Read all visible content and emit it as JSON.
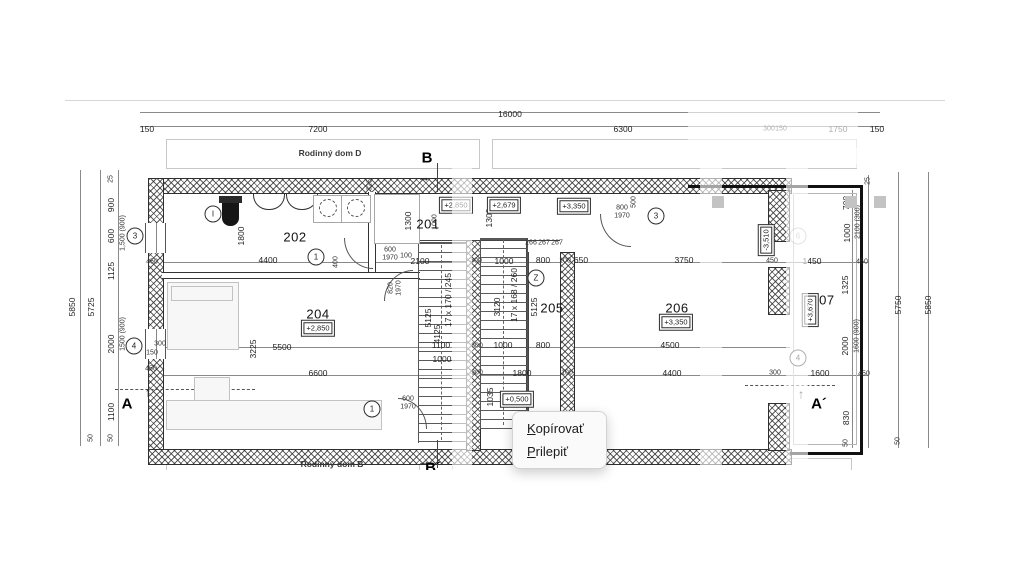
{
  "context_menu": {
    "items": [
      {
        "label": "Kopírovať",
        "mnemonic": "K",
        "rest": "opírovať"
      },
      {
        "label": "Prilepiť",
        "mnemonic": "P",
        "rest": "rilepiť"
      }
    ]
  },
  "plan": {
    "building_labels": [
      {
        "t": "Rodinný dom D",
        "x": 330,
        "y": 153
      },
      {
        "t": "Rodinný dom B",
        "x": 332,
        "y": 464
      }
    ],
    "section_markers": [
      {
        "t": "B",
        "x": 427,
        "y": 158
      },
      {
        "t": "B´",
        "x": 433,
        "y": 468
      },
      {
        "t": "A",
        "x": 127,
        "y": 404
      },
      {
        "t": "A´",
        "x": 819,
        "y": 404
      }
    ],
    "room_labels": [
      {
        "t": "202",
        "x": 295,
        "y": 237
      },
      {
        "t": "201",
        "x": 428,
        "y": 224
      },
      {
        "t": "204",
        "x": 318,
        "y": 314
      },
      {
        "t": "205",
        "x": 552,
        "y": 308
      },
      {
        "t": "206",
        "x": 677,
        "y": 308
      },
      {
        "t": "207",
        "x": 823,
        "y": 300
      }
    ],
    "elevation_labels": [
      {
        "t": "+2,850",
        "x": 456,
        "y": 205
      },
      {
        "t": "+2,679",
        "x": 504,
        "y": 205
      },
      {
        "t": "+3,350",
        "x": 574,
        "y": 206
      },
      {
        "t": "+2,850",
        "x": 318,
        "y": 328
      },
      {
        "t": "+3,350",
        "x": 676,
        "y": 322
      },
      {
        "t": "+0,500",
        "x": 517,
        "y": 399
      },
      {
        "t": "-3,510",
        "x": 766,
        "y": 240,
        "r": 1
      },
      {
        "t": "+3,670",
        "x": 810,
        "y": 310,
        "r": 1
      }
    ],
    "circle_markers": [
      {
        "t": "I",
        "x": 213,
        "y": 214
      },
      {
        "t": "1",
        "x": 316,
        "y": 257
      },
      {
        "t": "3",
        "x": 656,
        "y": 216
      },
      {
        "t": "1",
        "x": 372,
        "y": 409
      },
      {
        "t": "Z",
        "x": 536,
        "y": 278
      },
      {
        "t": "3",
        "x": 135,
        "y": 236
      },
      {
        "t": "4",
        "x": 134,
        "y": 346
      },
      {
        "t": "4",
        "x": 798,
        "y": 358
      },
      {
        "t": "6",
        "x": 798,
        "y": 236,
        "g": 1
      }
    ],
    "stair_labels": [
      {
        "t": "17 x 170 / 245",
        "x": 448,
        "y": 300,
        "r": 1
      },
      {
        "t": "17 x 168 / 260",
        "x": 514,
        "y": 295,
        "r": 1
      }
    ],
    "icons": [
      {
        "name": "section-arrow-up",
        "glyph": "↑",
        "x": 148,
        "y": 392
      },
      {
        "name": "section-arrow-up",
        "glyph": "↑",
        "x": 801,
        "y": 394
      },
      {
        "name": "section-arrow-right",
        "glyph": "→",
        "x": 424,
        "y": 177
      },
      {
        "name": "section-arrow-right",
        "glyph": "→",
        "x": 424,
        "y": 461
      }
    ],
    "dim_labels": [
      {
        "t": "16000",
        "x": 510,
        "y": 114
      },
      {
        "t": "150",
        "x": 147,
        "y": 129
      },
      {
        "t": "7200",
        "x": 318,
        "y": 129
      },
      {
        "t": "6300",
        "x": 623,
        "y": 129
      },
      {
        "t": "300",
        "x": 769,
        "y": 129,
        "s": 1
      },
      {
        "t": "150",
        "x": 781,
        "y": 129,
        "s": 1
      },
      {
        "t": "1750",
        "x": 838,
        "y": 129
      },
      {
        "t": "150",
        "x": 877,
        "y": 129
      },
      {
        "t": "4400",
        "x": 268,
        "y": 260
      },
      {
        "t": "600",
        "x": 390,
        "y": 250,
        "s": 1
      },
      {
        "t": "1970",
        "x": 390,
        "y": 258,
        "s": 1
      },
      {
        "t": "100",
        "x": 406,
        "y": 256,
        "s": 1
      },
      {
        "t": "2100",
        "x": 420,
        "y": 261
      },
      {
        "t": "300",
        "x": 476,
        "y": 261,
        "s": 1
      },
      {
        "t": "1000",
        "x": 504,
        "y": 261
      },
      {
        "t": "800",
        "x": 543,
        "y": 260
      },
      {
        "t": "100",
        "x": 565,
        "y": 261,
        "s": 1
      },
      {
        "t": "650",
        "x": 581,
        "y": 260
      },
      {
        "t": "3750",
        "x": 684,
        "y": 260
      },
      {
        "t": "450",
        "x": 772,
        "y": 261,
        "s": 1
      },
      {
        "t": "1450",
        "x": 812,
        "y": 261
      },
      {
        "t": "450",
        "x": 862,
        "y": 262,
        "s": 1
      },
      {
        "t": "266",
        "x": 531,
        "y": 243,
        "s": 1
      },
      {
        "t": "267",
        "x": 544,
        "y": 243,
        "s": 1
      },
      {
        "t": "267",
        "x": 557,
        "y": 243,
        "s": 1
      },
      {
        "t": "800",
        "x": 622,
        "y": 208,
        "s": 1
      },
      {
        "t": "1970",
        "x": 622,
        "y": 216,
        "s": 1
      },
      {
        "t": "500",
        "x": 634,
        "y": 202,
        "r": 1,
        "s": 1
      },
      {
        "t": "5500",
        "x": 282,
        "y": 347
      },
      {
        "t": "1100",
        "x": 441,
        "y": 345
      },
      {
        "t": "300",
        "x": 477,
        "y": 346,
        "s": 1
      },
      {
        "t": "1000",
        "x": 503,
        "y": 345
      },
      {
        "t": "800",
        "x": 543,
        "y": 345
      },
      {
        "t": "4500",
        "x": 670,
        "y": 345
      },
      {
        "t": "1000",
        "x": 442,
        "y": 359
      },
      {
        "t": "6600",
        "x": 318,
        "y": 373
      },
      {
        "t": "300",
        "x": 477,
        "y": 373,
        "s": 1
      },
      {
        "t": "1800",
        "x": 522,
        "y": 373
      },
      {
        "t": "100",
        "x": 567,
        "y": 373,
        "s": 1
      },
      {
        "t": "4400",
        "x": 672,
        "y": 373
      },
      {
        "t": "300",
        "x": 775,
        "y": 373,
        "s": 1
      },
      {
        "t": "1600",
        "x": 820,
        "y": 373
      },
      {
        "t": "450",
        "x": 864,
        "y": 374,
        "s": 1
      },
      {
        "t": "600",
        "x": 408,
        "y": 399,
        "s": 1
      },
      {
        "t": "1970",
        "x": 408,
        "y": 407,
        "s": 1
      },
      {
        "t": "450",
        "x": 152,
        "y": 262,
        "s": 1
      },
      {
        "t": "300",
        "x": 160,
        "y": 344,
        "s": 1
      },
      {
        "t": "150",
        "x": 152,
        "y": 353,
        "s": 1
      },
      {
        "t": "450",
        "x": 151,
        "y": 369,
        "s": 1
      },
      {
        "t": "1800",
        "x": 241,
        "y": 236,
        "r": 1
      },
      {
        "t": "325",
        "x": 370,
        "y": 185,
        "r": 1,
        "s": 1
      },
      {
        "t": "1300",
        "x": 408,
        "y": 221,
        "r": 1
      },
      {
        "t": "1000",
        "x": 435,
        "y": 222,
        "r": 1,
        "s": 1
      },
      {
        "t": "1300",
        "x": 489,
        "y": 218,
        "r": 1
      },
      {
        "t": "400",
        "x": 336,
        "y": 262,
        "r": 1,
        "s": 1
      },
      {
        "t": "820",
        "x": 391,
        "y": 288,
        "r": 1,
        "s": 1
      },
      {
        "t": "1970",
        "x": 399,
        "y": 288,
        "r": 1,
        "s": 1
      },
      {
        "t": "3225",
        "x": 253,
        "y": 349,
        "r": 1
      },
      {
        "t": "5125",
        "x": 428,
        "y": 318,
        "r": 1
      },
      {
        "t": "4125",
        "x": 437,
        "y": 334,
        "r": 1
      },
      {
        "t": "3120",
        "x": 497,
        "y": 307,
        "r": 1
      },
      {
        "t": "5125",
        "x": 534,
        "y": 307,
        "r": 1
      },
      {
        "t": "1035",
        "x": 490,
        "y": 397,
        "r": 1
      },
      {
        "t": "5850",
        "x": 72,
        "y": 307,
        "r": 1
      },
      {
        "t": "5725",
        "x": 91,
        "y": 307,
        "r": 1
      },
      {
        "t": "25",
        "x": 111,
        "y": 179,
        "r": 1,
        "s": 1
      },
      {
        "t": "900",
        "x": 111,
        "y": 205,
        "r": 1
      },
      {
        "t": "600",
        "x": 111,
        "y": 236,
        "r": 1
      },
      {
        "t": "1,500 (900)",
        "x": 123,
        "y": 233,
        "r": 1,
        "s": 1
      },
      {
        "t": "1125",
        "x": 111,
        "y": 271,
        "r": 1
      },
      {
        "t": "2000",
        "x": 111,
        "y": 344,
        "r": 1
      },
      {
        "t": "1500 (900)",
        "x": 123,
        "y": 334,
        "r": 1,
        "s": 1
      },
      {
        "t": "1100",
        "x": 111,
        "y": 412,
        "r": 1
      },
      {
        "t": "50",
        "x": 111,
        "y": 438,
        "r": 1,
        "s": 1
      },
      {
        "t": "50",
        "x": 91,
        "y": 438,
        "r": 1,
        "s": 1
      },
      {
        "t": "5750",
        "x": 898,
        "y": 305,
        "r": 1
      },
      {
        "t": "5850",
        "x": 928,
        "y": 305,
        "r": 1
      },
      {
        "t": "25",
        "x": 868,
        "y": 181,
        "r": 1,
        "s": 1
      },
      {
        "t": "700",
        "x": 846,
        "y": 203,
        "r": 1
      },
      {
        "t": "1000",
        "x": 847,
        "y": 233,
        "r": 1
      },
      {
        "t": "2100 (300)",
        "x": 858,
        "y": 222,
        "r": 1,
        "s": 1
      },
      {
        "t": "1325",
        "x": 845,
        "y": 285,
        "r": 1
      },
      {
        "t": "2000",
        "x": 845,
        "y": 346,
        "r": 1
      },
      {
        "t": "1600 (900)",
        "x": 857,
        "y": 336,
        "r": 1,
        "s": 1
      },
      {
        "t": "830",
        "x": 846,
        "y": 418,
        "r": 1
      },
      {
        "t": "50",
        "x": 846,
        "y": 443,
        "r": 1,
        "s": 1
      },
      {
        "t": "50",
        "x": 898,
        "y": 441,
        "r": 1,
        "s": 1
      }
    ]
  }
}
